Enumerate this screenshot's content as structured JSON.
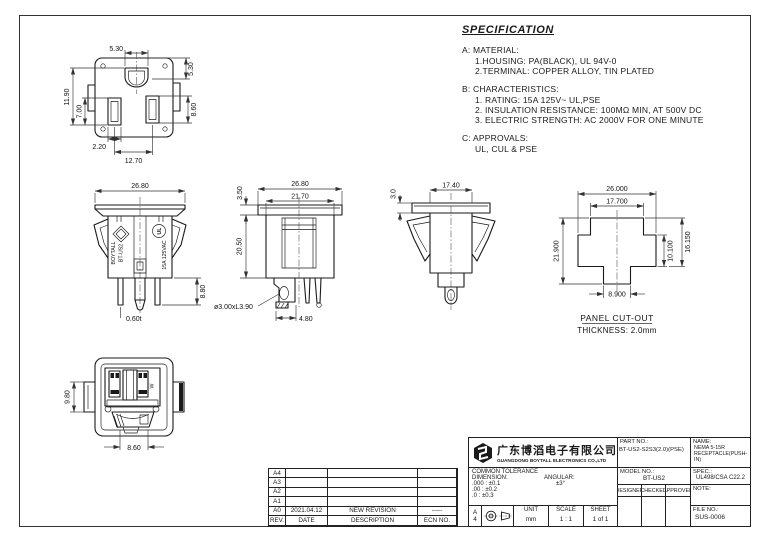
{
  "colors": {
    "ink": "#1a1a1a",
    "paper": "#ffffff"
  },
  "spec": {
    "title": "SPECIFICATION",
    "sections": [
      {
        "label": "A: MATERIAL:",
        "items": [
          "1.HOUSING: PA(BLACK), UL 94V-0",
          "2.TERMINAL: COPPER ALLOY, TIN PLATED"
        ]
      },
      {
        "label": "B: CHARACTERISTICS:",
        "items": [
          "1. RATING: 15A 125V~ UL,PSE",
          "2. INSULATION RESISTANCE: 100MΩ MIN, AT 500V DC",
          "3. ELECTRIC STRENGTH: AC 2000V FOR ONE MINUTE"
        ]
      },
      {
        "label": "C: APPROVALS:",
        "items": [
          "UL, CUL & PSE"
        ]
      }
    ]
  },
  "views": {
    "face": {
      "dims": {
        "slot_width_top": "5.30",
        "depth_right": "5.30",
        "left_outer": "11.90",
        "left_inner": "7.00",
        "right_slot": "8.60",
        "bottom_small": "2.20",
        "bottom_pitch": "12.70"
      }
    },
    "front": {
      "dims": {
        "width": "26.80",
        "terminal_len": "8.80",
        "thickness": "0.60t"
      },
      "markings": {
        "brand": "BOYTALL",
        "model": "BT-US2",
        "rating": "15A 125VAC",
        "ul": "UL"
      }
    },
    "side": {
      "dims": {
        "flange_width": "26.80",
        "body_width": "21.70",
        "flange_h": "3.50",
        "body_h": "20.50",
        "pin": "ø3.00xL3.90",
        "pin_pitch": "4.80"
      }
    },
    "side2": {
      "dims": {
        "width": "17.40",
        "flange_h": "3.0"
      }
    },
    "cutout": {
      "dims": {
        "width": "26.000",
        "top_width": "17.700",
        "height": "21.900",
        "mid_height": "10.100",
        "upper_height": "16.150",
        "bottom_width": "8.900"
      },
      "caption": "PANEL CUT-OUT",
      "thickness": "THICKNESS: 2.0mm"
    },
    "back": {
      "dims": {
        "tab_height": "9.80",
        "mouth_width": "8.60"
      },
      "markings": {
        "w": "W"
      }
    }
  },
  "revision_table": {
    "headers": [
      "REV.",
      "DATE",
      "DESCRIPTION",
      "ECN NO."
    ],
    "rows": [
      [
        "A4",
        "",
        "",
        ""
      ],
      [
        "A3",
        "",
        "",
        ""
      ],
      [
        "A2",
        "",
        "",
        ""
      ],
      [
        "A1",
        "",
        "",
        ""
      ],
      [
        "A0",
        "2021.04.12",
        "NEW REVISION",
        "-----"
      ]
    ]
  },
  "title_block": {
    "company_cn": "广东博滔电子有限公司",
    "company_en": "GUANGDONG BOYTALL ELECTRONICS CO.,LTD",
    "part_no_label": "PART NO.:",
    "part_no": "BT-US2-S2S3(2.0)(PSE)",
    "name_label": "NAME:",
    "name_line1": "NEMA 5-15R",
    "name_line2": "RECEPTACLE(PUSH-IN)",
    "model_no_label": "MODEL NO.:",
    "model_no": "BT-US2",
    "spec_label": "SPEC.:",
    "spec_value": "UL498/CSA C22.2",
    "designer_label": "DESIGNER",
    "checked_label": "CHECKED",
    "approved_label": "APPROVED",
    "note_label": "NOTE:",
    "file_no_label": "FILE NO.:",
    "file_no": "SUS-0006",
    "tolerance_title": "COMMON TOLERANCE",
    "dimension_label": "DIMENSION:",
    "angular_label": "ANGULAR:",
    "tol_rows": [
      ".000 : ±0.1",
      ".00 : ±0.2",
      ".0  : ±0.3"
    ],
    "angular_value": "±3°",
    "paper_size_letter": "A",
    "paper_size_number": "4",
    "unit_label": "UNIT",
    "unit_value": "mm",
    "scale_label": "SCALE",
    "scale_value": "1 : 1",
    "sheet_label": "SHEET",
    "sheet_value": "1 of 1"
  }
}
